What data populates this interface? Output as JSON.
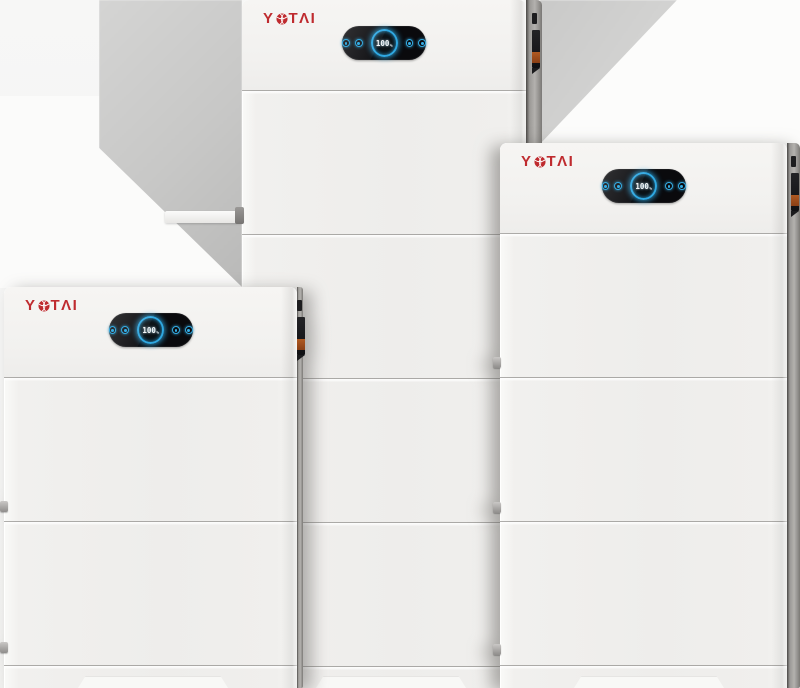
{
  "product": {
    "brand": "YOTAI",
    "description_on_screen": "three stacked white battery energy-storage towers, each with a YOTAI logo and a black oval status display reading 100%"
  },
  "units": {
    "middle": {
      "brand": "YOTAI",
      "brand_prefix": "Y",
      "brand_display_suffix": "TΛI",
      "display": {
        "battery_level": "100",
        "battery_unit": "%"
      }
    },
    "right": {
      "brand": "YOTAI",
      "brand_prefix": "Y",
      "brand_display_suffix": "TΛI",
      "display": {
        "battery_level": "100",
        "battery_unit": "%"
      }
    },
    "left": {
      "brand": "YOTAI",
      "brand_prefix": "Y",
      "brand_display_suffix": "TΛI",
      "display": {
        "battery_level": "100",
        "battery_unit": "%"
      }
    }
  },
  "icons": {
    "globe-icon": "red sphere with white arc stripes (logo O)",
    "indicator-icon": "small glowing blue dot",
    "battery-level-ring": "blue glowing circle around charge value"
  },
  "colors": {
    "brand_red": "#bf2b2f",
    "display_ring_blue": "#2fa8e2",
    "display_background": "#0a0a0d",
    "connector_orange": "#a8521f",
    "cabinet_white": "#f0efed",
    "shadow_gray": "#c7c7c6"
  }
}
